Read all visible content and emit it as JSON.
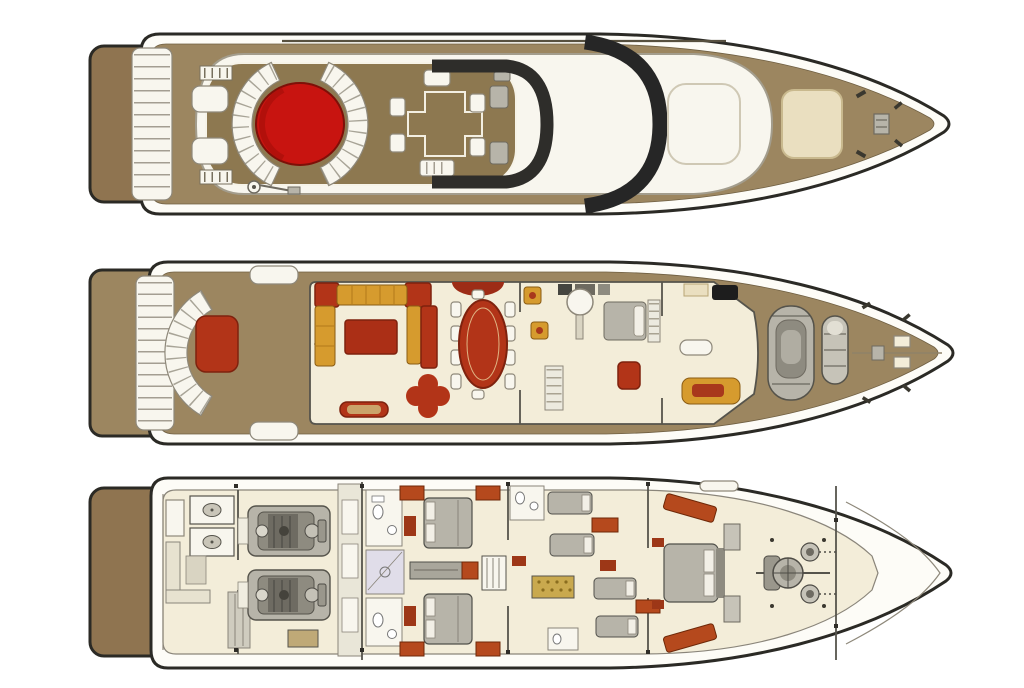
{
  "image": {
    "width": 1024,
    "height": 688,
    "background": "#ffffff",
    "kind": "yacht-deck-plan-diagram",
    "text_labels": []
  },
  "colors": {
    "outline": "#2b2a25",
    "hull_white": "#fdfcf7",
    "teak": "#9c8660",
    "teak_dark": "#8d7850",
    "platform_brown": "#8f7450",
    "cream": "#f3edd9",
    "white_soft": "#f8f6ee",
    "sunpad": "#eadfc0",
    "red_bright": "#c81410",
    "red": "#b23418",
    "red_dark": "#7e220e",
    "rust": "#b5491d",
    "rust_dark": "#6e2808",
    "gold": "#d69b2e",
    "gold_dark": "#8a5c14",
    "gold_tile": "#c9a94e",
    "gray_light": "#c6c3b8",
    "gray_mid": "#b7b4a9",
    "gray_deep": "#8e8b80",
    "gray_dark": "#55534b",
    "charcoal": "#262626",
    "line_gray": "#8e887a",
    "wall": "#56544c",
    "lavender": "#e0dde9",
    "tan_box": "#bfa977"
  },
  "decks": [
    {
      "id": "flybridge-deck",
      "position": "top",
      "features": [
        "swim-platform",
        "stern-steps",
        "davit-crane",
        "jacuzzi",
        "curved-seat-port",
        "curved-seat-starboard",
        "sun-loungers",
        "cross-dining-table",
        "radar-arch",
        "windscreen",
        "hardtop-roof",
        "roof-hatch",
        "bow-sunpad",
        "anchor-windlass",
        "bow-cleats"
      ]
    },
    {
      "id": "main-deck",
      "position": "middle",
      "features": [
        "swim-platform",
        "stern-steps",
        "aft-curved-bench",
        "aft-table",
        "boarding-gates",
        "salon-u-sofa",
        "coffee-table",
        "clover-side-table",
        "aft-sideboard",
        "dining-oval-table",
        "dining-chairs",
        "bar-stools",
        "galley-appliances",
        "galley-round-table",
        "companionway-stairs",
        "captain-berth",
        "helm-console",
        "helm-seat",
        "pilothouse-bench",
        "foredeck-jetski",
        "foredeck-tender",
        "bow-hatches"
      ]
    },
    {
      "id": "lower-deck",
      "position": "bottom",
      "features": [
        "swim-platform",
        "crew-quarters",
        "laundry-washers",
        "crew-sofa",
        "crew-locker",
        "generator",
        "engine-room-port-engine",
        "engine-room-starboard-engine",
        "technical-corridor",
        "port-double-cabin",
        "starboard-double-cabin",
        "cabin-bathrooms",
        "central-dresser",
        "companionway-steps",
        "guest-twin-cabin-port",
        "guest-twin-cabin-starboard",
        "gold-tile-shower",
        "vip-cabin",
        "vip-wardrobes",
        "anchor-windlass",
        "forepeak"
      ]
    }
  ]
}
